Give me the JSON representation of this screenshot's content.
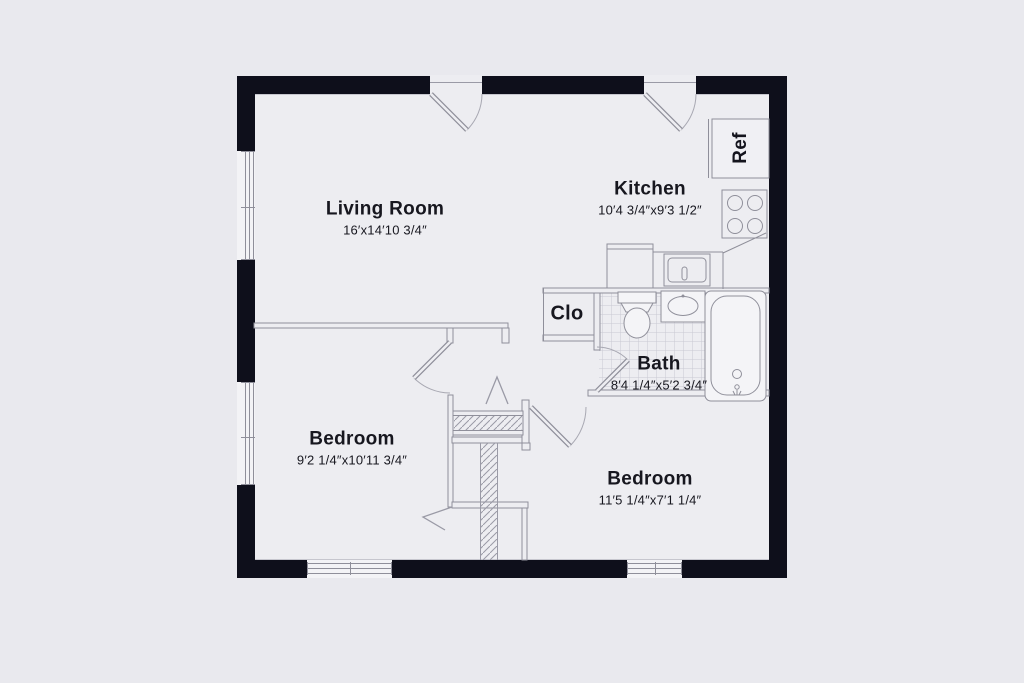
{
  "plan": {
    "rooms": [
      {
        "id": "living-room",
        "name": "Living Room",
        "dims": "16′x14′10 3/4″"
      },
      {
        "id": "kitchen",
        "name": "Kitchen",
        "dims": "10′4 3/4″x9′3 1/2″"
      },
      {
        "id": "bath",
        "name": "Bath",
        "dims": "8′4 1/4″x5′2 3/4″"
      },
      {
        "id": "bedroom-1",
        "name": "Bedroom",
        "dims": "9′2 1/4″x10′11 3/4″"
      },
      {
        "id": "bedroom-2",
        "name": "Bedroom",
        "dims": "11′5 1/4″x7′1 1/4″"
      },
      {
        "id": "closet",
        "name": "Clo",
        "dims": ""
      }
    ],
    "appliances": {
      "refrigerator": "Ref"
    },
    "colors": {
      "wall": "#0e0f1b",
      "background": "#e9e9ee",
      "floor": "#ededf1",
      "line": "#8f8f9a",
      "text": "#17171f"
    }
  }
}
